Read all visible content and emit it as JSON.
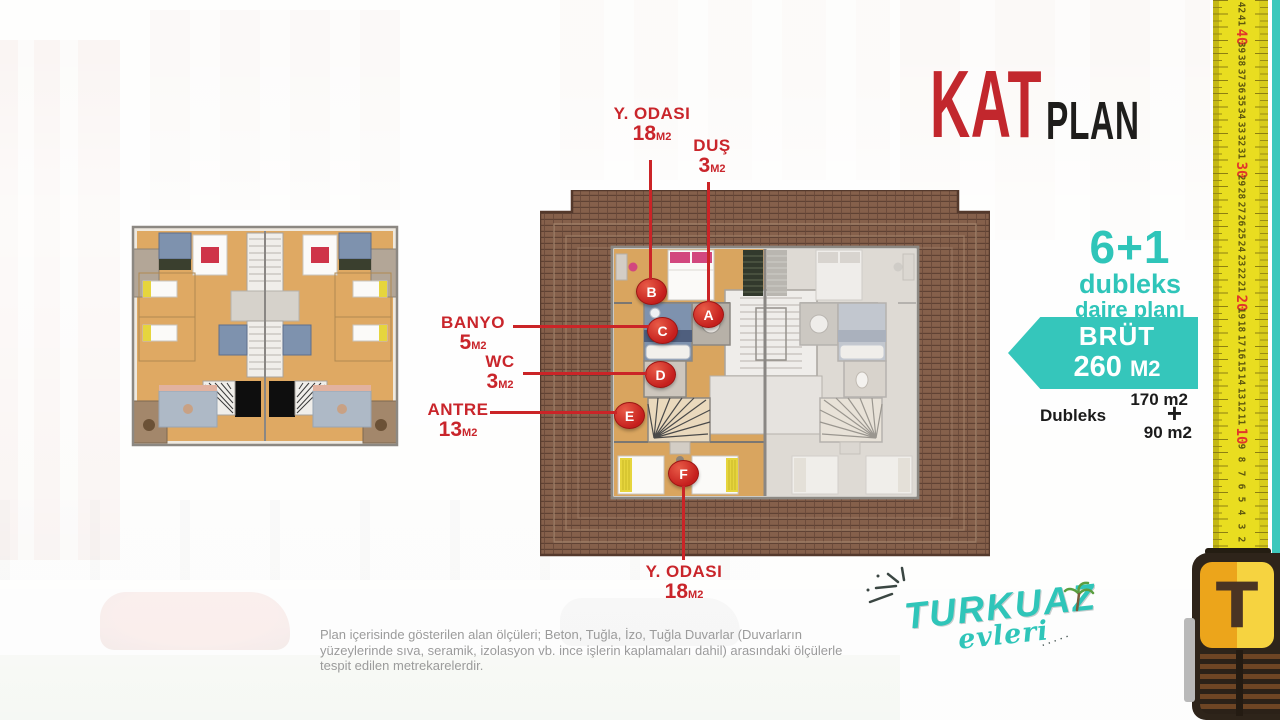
{
  "title": {
    "kat": "KAT",
    "plan": "PLAN"
  },
  "offer": {
    "rooms": "6+1",
    "type": "dubleks",
    "plan_word": "daire planı",
    "gross_label": "BRÜT",
    "gross_value": "260",
    "gross_unit": "M2",
    "area_main": "170 m2",
    "area_type": "Dubleks",
    "plus": "+",
    "area_upper": "90 m2"
  },
  "labels": {
    "top_bedroom": {
      "name": "Y. ODASI",
      "value": "18",
      "unit": "M2"
    },
    "shower": {
      "name": "DUŞ",
      "value": "3",
      "unit": "M2"
    },
    "bathroom": {
      "name": "BANYO",
      "value": "5",
      "unit": "M2"
    },
    "wc": {
      "name": "WC",
      "value": "3",
      "unit": "M2"
    },
    "hall": {
      "name": "ANTRE",
      "value": "13",
      "unit": "M2"
    },
    "bottom_bedroom": {
      "name": "Y. ODASI",
      "value": "18",
      "unit": "M2"
    }
  },
  "markers": {
    "a": "A",
    "b": "B",
    "c": "C",
    "d": "D",
    "e": "E",
    "f": "F"
  },
  "disclaimer": "Plan içerisinde gösterilen alan ölçüleri; Beton, Tuğla, İzo, Tuğla Duvarlar (Duvarların yüzeylerinde sıva, seramik, izolasyon vb. ince işlerin kaplamaları dahil) arasındaki ölçülerle tespit edilen metrekarelerdir.",
  "logo": {
    "brand": "TURKUAZ",
    "sub": "evleri"
  },
  "ruler": {
    "max": 42,
    "min": 2,
    "red_interval": 10
  },
  "colors": {
    "teal": "#35c6bb",
    "label_red": "#c9252b",
    "marker_red": "#c51f1d",
    "ruler_yellow": "#e9dd20"
  }
}
